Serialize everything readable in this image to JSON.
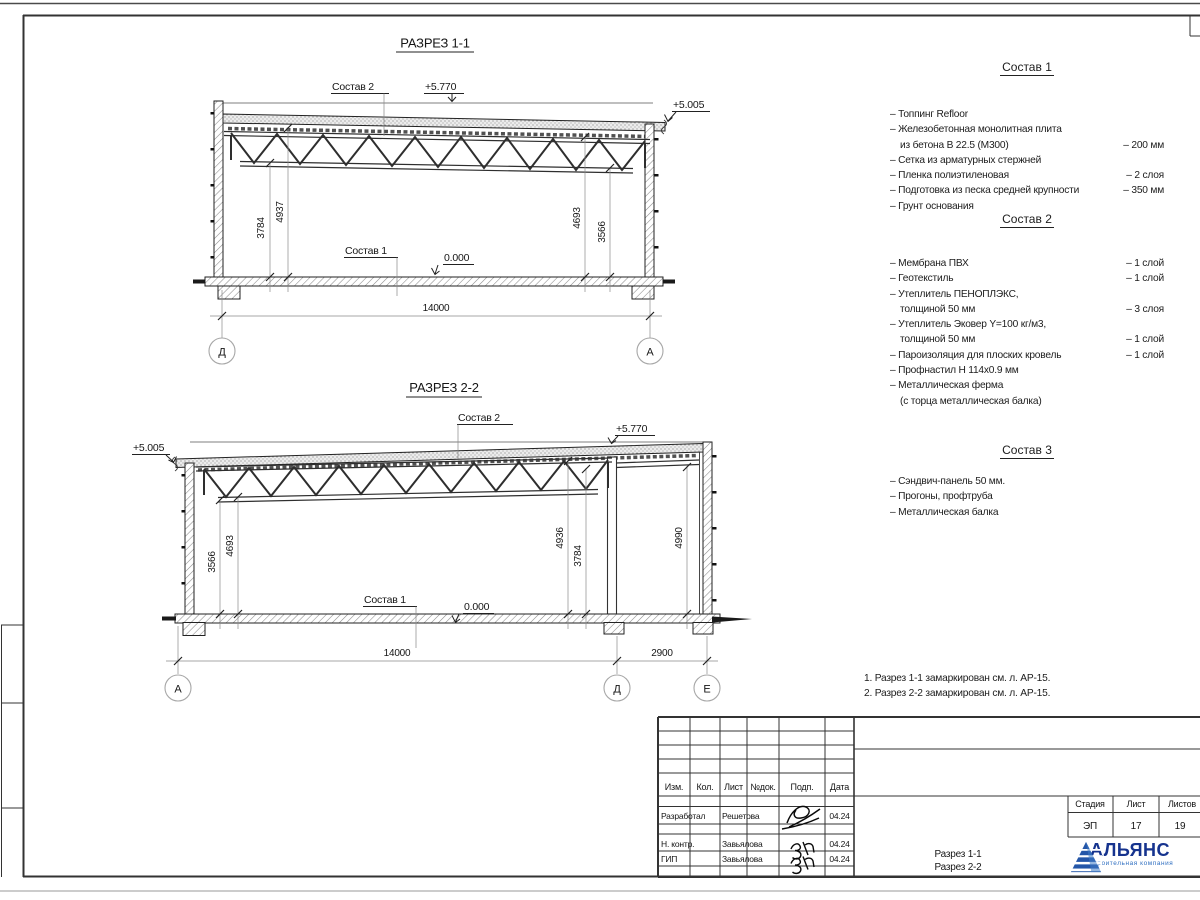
{
  "sections": [
    {
      "title": "РАЗРЕЗ 1-1",
      "label_roof": "Состав 2",
      "label_floor": "Состав 1",
      "elev_top": "+5.770",
      "elev_eave": "+5.005",
      "elev_zero": "0.000",
      "dims": {
        "l1": "3784",
        "l2": "4937",
        "r1": "4693",
        "r2": "3566",
        "span": "14000"
      },
      "axes": {
        "left": "Д",
        "right": "А"
      }
    },
    {
      "title": "РАЗРЕЗ 2-2",
      "label_roof": "Состав 2",
      "label_floor": "Состав 1",
      "elev_top": "+5.770",
      "elev_eave": "+5.005",
      "elev_zero": "0.000",
      "dims": {
        "l1": "3566",
        "l2": "4693",
        "m1": "4936",
        "m2": "3784",
        "r1": "4990",
        "span": "14000",
        "span2": "2900"
      },
      "axes": {
        "left": "А",
        "mid": "Д",
        "right": "Е"
      }
    }
  ],
  "compositions": [
    {
      "title": "Состав 1",
      "items": [
        {
          "t": "– Топпинг Refloor",
          "v": ""
        },
        {
          "t": "– Железобетонная  монолитная плита",
          "v": ""
        },
        {
          "t": "из бетона В 22.5 (М300)",
          "v": "– 200 мм"
        },
        {
          "t": "– Сетка из арматурных стержней",
          "v": ""
        },
        {
          "t": "– Пленка полиэтиленовая",
          "v": "– 2 слоя"
        },
        {
          "t": "– Подготовка из песка средней крупности",
          "v": "– 350 мм"
        },
        {
          "t": "– Грунт основания",
          "v": ""
        }
      ]
    },
    {
      "title": "Состав 2",
      "items": [
        {
          "t": "– Мембрана ПВХ",
          "v": "– 1 слой"
        },
        {
          "t": "– Геотекстиль",
          "v": "– 1 слой"
        },
        {
          "t": "– Утеплитель ПЕНОПЛЭКС,",
          "v": ""
        },
        {
          "t": "толщиной 50 мм",
          "v": "– 3 слоя"
        },
        {
          "t": "– Утеплитель Эковер Y=100 кг/м3,",
          "v": ""
        },
        {
          "t": "толщиной 50 мм",
          "v": "– 1 слой"
        },
        {
          "t": "– Пароизоляция для плоских кровель",
          "v": "– 1 слой"
        },
        {
          "t": "– Профнастил Н 114х0.9 мм",
          "v": ""
        },
        {
          "t": "– Металлическая ферма",
          "v": ""
        },
        {
          "t": "(с торца металлическая балка)",
          "v": ""
        }
      ]
    },
    {
      "title": "Состав 3",
      "items": [
        {
          "t": "– Сэндвич-панель 50 мм.",
          "v": ""
        },
        {
          "t": "– Прогоны, профтруба",
          "v": ""
        },
        {
          "t": "– Металлическая балка",
          "v": ""
        }
      ]
    }
  ],
  "notes": {
    "line1": "1. Разрез 1-1 замаркирован см. л. АР-15.",
    "line2": "2. Разрез 2-2 замаркирован см. л. АР-15."
  },
  "titleblock": {
    "headers": [
      "Изм.",
      "Кол.",
      "Лист",
      "№док.",
      "Подп.",
      "Дата"
    ],
    "rows": [
      {
        "role": "Разработал",
        "name": "Решетова",
        "date": "04.24"
      },
      {
        "role": "Н. контр.",
        "name": "Завьялова",
        "date": "04.24"
      },
      {
        "role": "ГИП",
        "name": "Завьялова",
        "date": "04.24"
      }
    ],
    "doc_name_line1": "Разрез 1-1",
    "doc_name_line2": "Разрез 2-2",
    "stage_label": "Стадия",
    "sheet_label": "Лист",
    "sheets_label": "Листов",
    "stage": "ЭП",
    "sheet": "17",
    "sheets": "19"
  },
  "logo": {
    "name": "АЛЬЯНС",
    "subtitle": "строительная компания",
    "color": "#16338e",
    "accent": "#2f6fc1"
  }
}
